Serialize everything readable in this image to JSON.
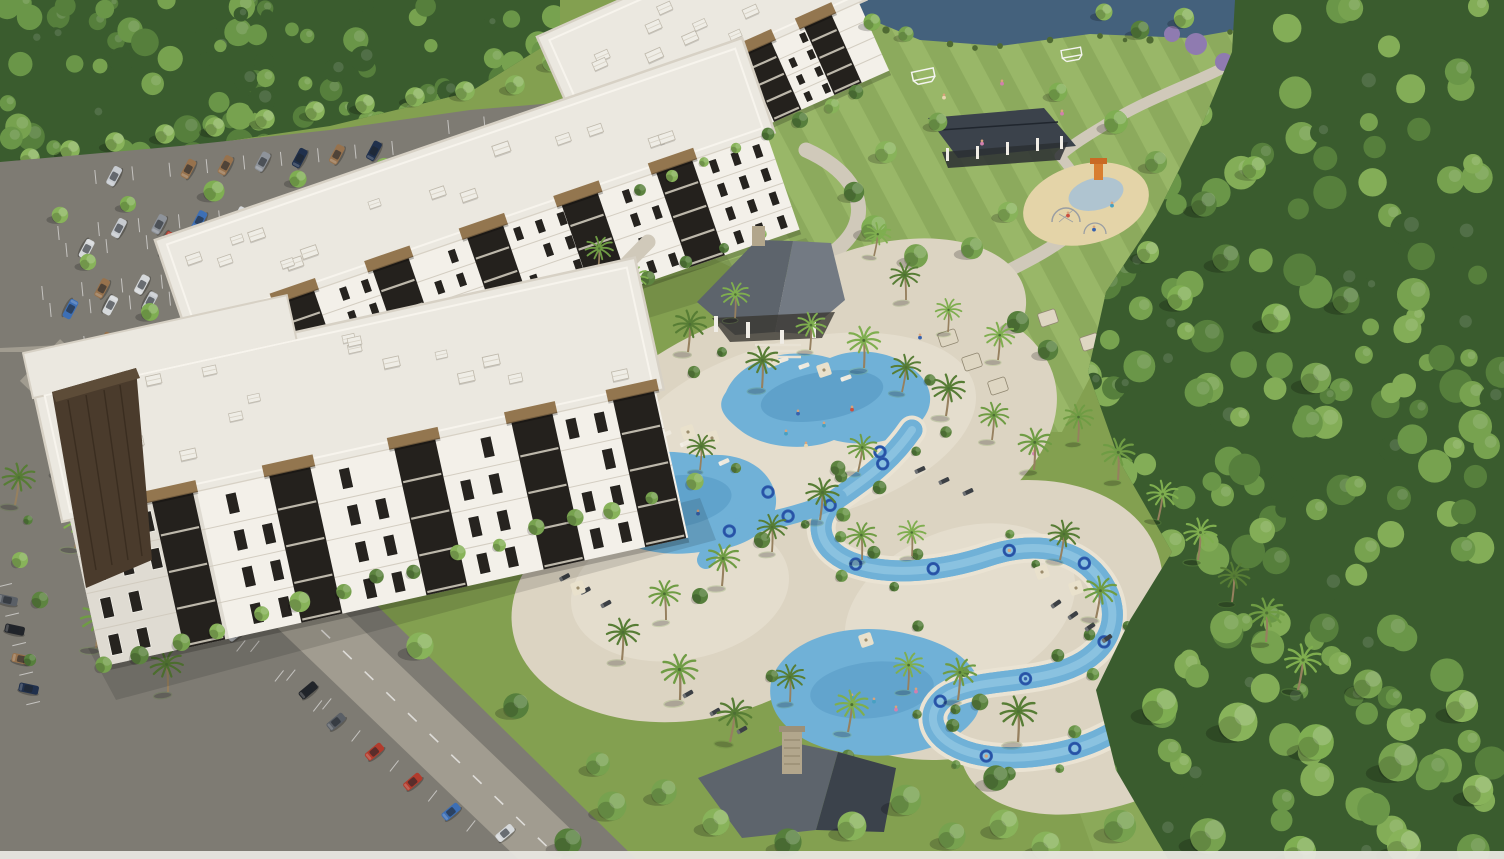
{
  "scene": {
    "type": "architectural-aerial-rendering",
    "description": "Daytime aerial rendering of a resort-style apartment community: three white four-story apartment buildings with dark balconies, a resort pool complex with lagoon pools and a winding lazy river with blue tubes, pool and lakeside pavilions, striped sports lawn with soccer goals, playground, pickleball and sand volleyball courts, tree-lined parking lots, a river and dense surrounding forest",
    "no_visible_text": true
  },
  "inventory": {
    "buildings": [
      "north-building",
      "middle-building",
      "foreground-building"
    ],
    "amenities": [
      "pool-pavilion",
      "lakeside-pavilion",
      "fireplace-pavilion",
      "lagoon-pool",
      "main-pool",
      "family-pool",
      "lazy-river",
      "playground",
      "sports-lawn",
      "soccer-goals",
      "pickleball-courts",
      "sand-volleyball-courts",
      "cabanas",
      "lounge-chairs",
      "umbrellas"
    ],
    "landscape": [
      "forest",
      "river",
      "striped-lawn",
      "palm-trees",
      "shade-trees",
      "hedges"
    ],
    "vehicles": "parked cars in north and southwest lots",
    "people": "swimmers, loungers and guests"
  },
  "palette": {
    "base": "#83a050",
    "grassLight": "#99b768",
    "stripe": "#6f8f44",
    "lawnBR": "#8fae5e",
    "forestDark": "#3a5c2e",
    "forestMid": "#567f3c",
    "forestLight": "#77a24f",
    "treeBright": "#88b35a",
    "palm": "#6f9c44",
    "palmDark": "#577d35",
    "bush": "#5d8440",
    "asphalt": "#7e7b73",
    "roadLight": "#a19c90",
    "concrete": "#c5bfb2",
    "deck": "#dcd4c2",
    "deckLight": "#eae3d3",
    "path": "#d0c9ba",
    "wall": "#f3f0e9",
    "wallShade": "#d6d1c7",
    "roof": "#ebe8e0",
    "roofEdge": "#d7d1c5",
    "dark": "#2a2622",
    "brown": "#4a3b2c",
    "awning": "#93764f",
    "slate": "#5d646c",
    "slateLight": "#737a83",
    "slateDark": "#3b424b",
    "stone": "#b2a68c",
    "river": "#44617c",
    "pool": "#70b1d7",
    "poolDeep": "#4e92be",
    "poolLight": "#aad6ea",
    "tube": "#2e5cb0",
    "sand": "#e4d4a8",
    "purple": "#8f7bb0",
    "white": "#ffffff",
    "skin": "#d9a37b",
    "carColors": [
      "#2f55a4",
      "#20304c",
      "#8e939a",
      "#5a5f66",
      "#b23b2c",
      "#22252a",
      "#d6d9db",
      "#97724d",
      "#3d6fb5",
      "#c7cbd0"
    ]
  }
}
